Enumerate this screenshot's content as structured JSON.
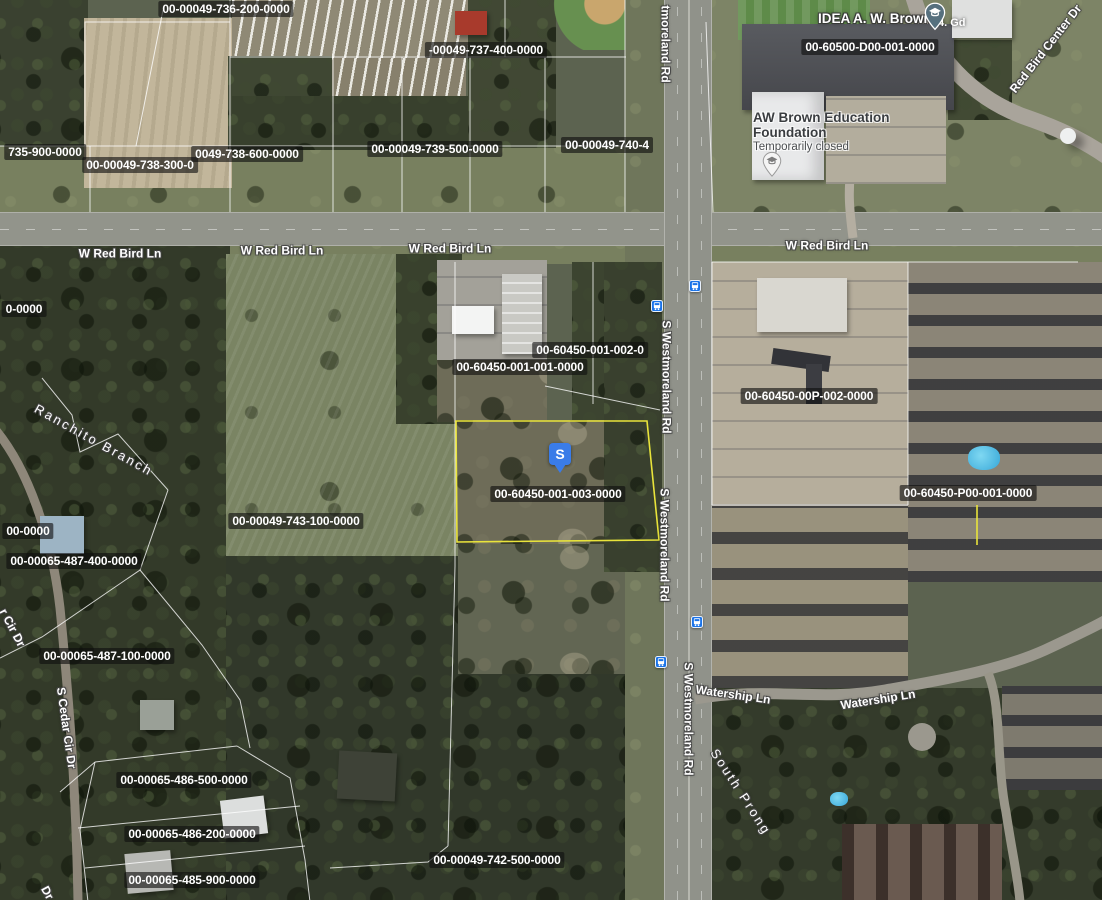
{
  "map": {
    "selected_marker": {
      "label": "S"
    },
    "colors": {
      "highlight_yellow": "#e9e43b",
      "marker_blue": "#3a7ce8",
      "transit_blue": "#1a73e8",
      "school_pin": "#56707e"
    },
    "parcel_labels": [
      {
        "text": "00-00049-736-200-0000",
        "x": 226,
        "y": 9
      },
      {
        "text": "-00049-737-400-0000",
        "x": 486,
        "y": 50
      },
      {
        "text": "00-60500-D00-001-0000",
        "x": 870,
        "y": 47
      },
      {
        "text": "735-900-0000",
        "x": 45,
        "y": 152
      },
      {
        "text": "00-00049-738-300-0",
        "x": 140,
        "y": 165
      },
      {
        "text": "0049-738-600-0000",
        "x": 247,
        "y": 154
      },
      {
        "text": "00-00049-739-500-0000",
        "x": 435,
        "y": 149
      },
      {
        "text": "00-00049-740-4",
        "x": 607,
        "y": 145
      },
      {
        "text": "00-60450-001-002-0",
        "x": 590,
        "y": 350
      },
      {
        "text": "00-60450-001-001-0000",
        "x": 520,
        "y": 367
      },
      {
        "text": "00-60450-00P-002-0000",
        "x": 809,
        "y": 396
      },
      {
        "text": "00-60450-001-003-0000",
        "x": 558,
        "y": 494
      },
      {
        "text": "00-60450-P00-001-0000",
        "x": 968,
        "y": 493
      },
      {
        "text": "00-00049-743-100-0000",
        "x": 296,
        "y": 521
      },
      {
        "text": "0-0000",
        "x": 24,
        "y": 309
      },
      {
        "text": "00-0000",
        "x": 28,
        "y": 531
      },
      {
        "text": "00-00065-487-400-0000",
        "x": 74,
        "y": 561
      },
      {
        "text": "00-00065-487-100-0000",
        "x": 107,
        "y": 656
      },
      {
        "text": "00-00065-486-500-0000",
        "x": 184,
        "y": 780
      },
      {
        "text": "00-00065-486-200-0000",
        "x": 192,
        "y": 834
      },
      {
        "text": "00-00065-485-900-0000",
        "x": 192,
        "y": 880
      },
      {
        "text": "00-00049-742-500-0000",
        "x": 497,
        "y": 860
      }
    ],
    "road_labels": [
      {
        "text": "W Red Bird Ln",
        "x": 120,
        "y": 254,
        "rotate": 0
      },
      {
        "text": "W Red Bird Ln",
        "x": 282,
        "y": 251,
        "rotate": 0
      },
      {
        "text": "W Red Bird Ln",
        "x": 450,
        "y": 249,
        "rotate": 0
      },
      {
        "text": "W Red Bird Ln",
        "x": 827,
        "y": 246,
        "rotate": 0
      },
      {
        "text": "tmoreland Rd",
        "x": 665,
        "y": 44,
        "rotate": 90
      },
      {
        "text": "S Westmoreland Rd",
        "x": 666,
        "y": 377,
        "rotate": 90
      },
      {
        "text": "S Westmoreland Rd",
        "x": 664,
        "y": 545,
        "rotate": 90
      },
      {
        "text": "S Westmoreland Rd",
        "x": 688,
        "y": 719,
        "rotate": 90
      },
      {
        "text": "Red Bird Center Dr",
        "x": 1046,
        "y": 49,
        "rotate": -52
      },
      {
        "text": "Watership Ln",
        "x": 733,
        "y": 695,
        "rotate": 8
      },
      {
        "text": "Watership Ln",
        "x": 878,
        "y": 700,
        "rotate": -9
      },
      {
        "text": "r Cir Dr",
        "x": 12,
        "y": 628,
        "rotate": 62
      },
      {
        "text": "S Cedar Cir Dr",
        "x": 66,
        "y": 728,
        "rotate": 82
      },
      {
        "text": "Dr",
        "x": 47,
        "y": 893,
        "rotate": 62
      }
    ],
    "water_labels": [
      {
        "text": "Ranchito Branch",
        "x": 94,
        "y": 440,
        "rotate": 29
      },
      {
        "text": "South Prong",
        "x": 741,
        "y": 792,
        "rotate": 57
      }
    ],
    "pois": {
      "school": {
        "name": "IDEA A. W. Brown",
        "extra": "4. Gd"
      },
      "foundation": {
        "name_line1": "AW Brown Education",
        "name_line2": "Foundation",
        "status": "Temporarily closed"
      }
    },
    "transit_stops": [
      {
        "x": 657,
        "y": 306
      },
      {
        "x": 695,
        "y": 286
      },
      {
        "x": 697,
        "y": 622
      },
      {
        "x": 661,
        "y": 662
      }
    ]
  }
}
